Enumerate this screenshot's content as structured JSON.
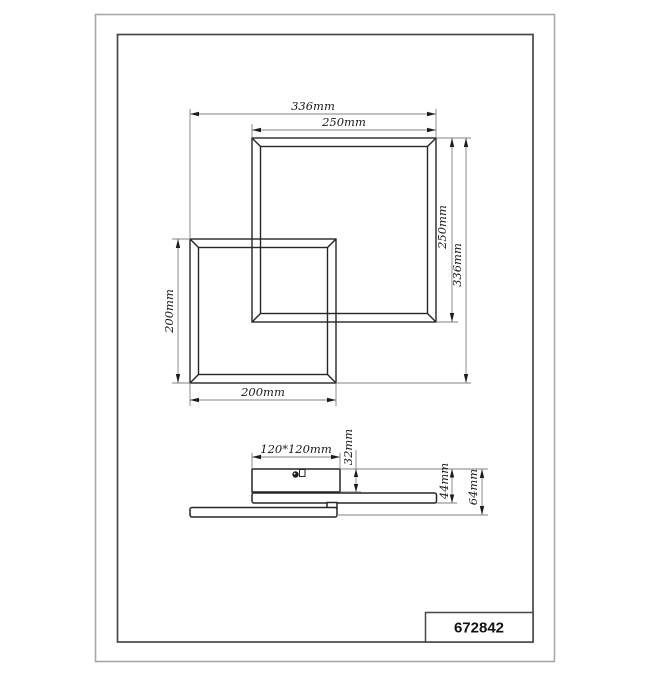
{
  "title_block": {
    "part_number": "672842"
  },
  "top_view": {
    "overall_width": "336mm",
    "large_frame_width": "250mm",
    "large_frame_height": "250mm",
    "overall_height": "336mm",
    "small_frame_height": "200mm",
    "small_frame_width": "200mm"
  },
  "side_view": {
    "canopy_size": "120*120mm",
    "canopy_height": "32mm",
    "frame_drop_height": "44mm",
    "total_height": "64mm"
  },
  "colors": {
    "geometry_line": "#262626",
    "dimension_line": "#828282",
    "border_outer": "#a8a8a8",
    "border_inner": "#474747"
  }
}
